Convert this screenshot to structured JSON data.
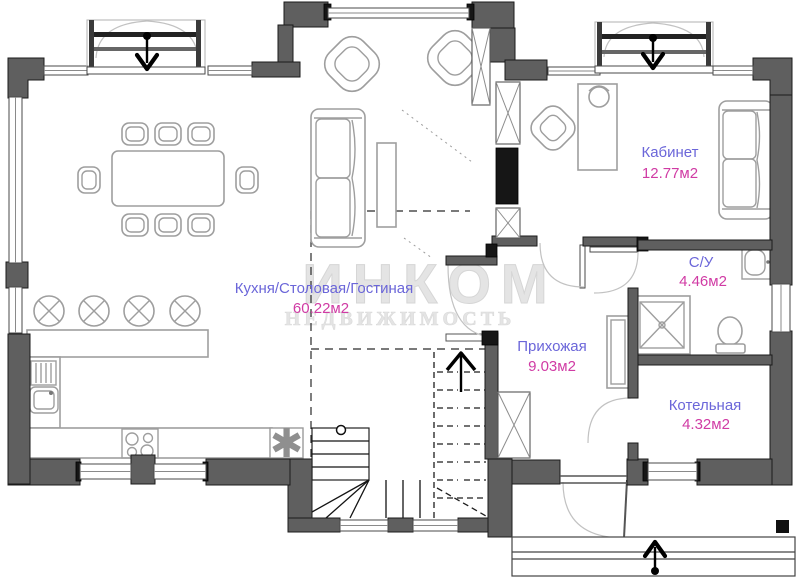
{
  "plan": {
    "rooms": [
      {
        "id": "kitchen-dining-living",
        "name": "Кухня/Столовая/Гостиная",
        "area": "60.22м2"
      },
      {
        "id": "office",
        "name": "Кабинет",
        "area": "12.77м2"
      },
      {
        "id": "bathroom",
        "name": "С/У",
        "area": "4.46м2"
      },
      {
        "id": "hallway",
        "name": "Прихожая",
        "area": "9.03м2"
      },
      {
        "id": "boiler-room",
        "name": "Котельная",
        "area": "4.32м2"
      }
    ],
    "watermark": {
      "line1": "ИНКОМ",
      "line2": "НЕДВИЖИМОСТЬ"
    },
    "symbols": {
      "boiler_mark": "✱"
    },
    "colors": {
      "wall": "#5f5f5f",
      "wall_dark": "#161616",
      "label": "#6b66d9",
      "area": "#d03ba4",
      "furniture": "#9e9e9e",
      "watermark": "#e4e4e4",
      "asterisk": "#8f8f8f"
    }
  }
}
